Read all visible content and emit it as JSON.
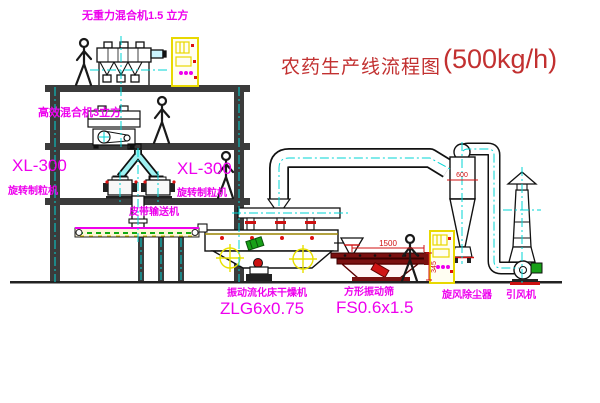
{
  "title": {
    "name": "农药生产线流程图",
    "capacity": "(500kg/h)"
  },
  "labels": {
    "gravity_mixer": "无重力混合机1.5 立方",
    "high_efficiency_mixer": "高效混合机3立方",
    "xl300_left": "XL-300",
    "granulator_left": "旋转制粒机",
    "xl300_mid": "XL-300",
    "granulator_mid": "旋转制粒机",
    "belt_conveyor": "皮带输送机",
    "fluidbed_dryer": "振动流化床干燥机",
    "fluidbed_model": "ZLG6x0.75",
    "square_screen": "方形振动筛",
    "square_screen_model": "FS0.6x1.5",
    "cyclone": "旋风除尘器",
    "induced_draft_fan": "引风机"
  },
  "dimensions": {
    "screen_length": "1500",
    "screen_height": "345",
    "cyclone_inlet": "600"
  },
  "colors": {
    "label_magenta": "#ee00ee",
    "title_red": "#c23030",
    "dimension_red": "#d01111",
    "centerline_cyan": "#00d5d5",
    "cabinet_yellow": "#e8d800",
    "structure_gray": "#3b3b3b",
    "motor_green": "#18a018"
  }
}
